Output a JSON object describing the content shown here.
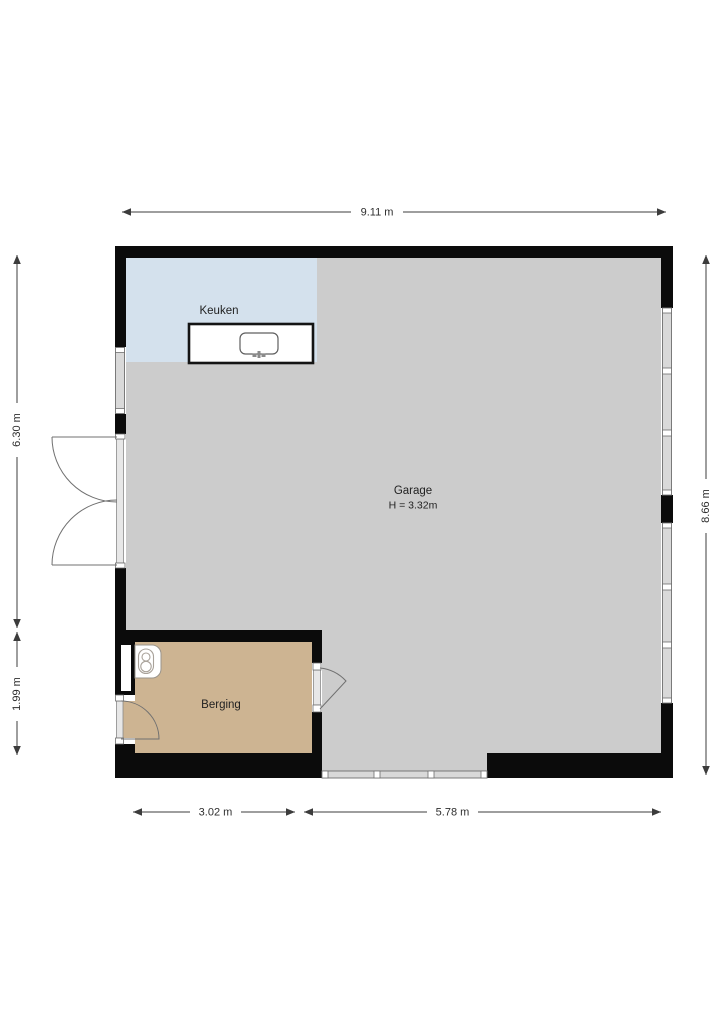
{
  "plan": {
    "title": "floor-plan",
    "rooms": {
      "keuken": {
        "label": "Keuken"
      },
      "garage": {
        "label": "Garage",
        "height": "H = 3.32m"
      },
      "berging": {
        "label": "Berging"
      }
    },
    "dimensions": {
      "top_width": "9.11 m",
      "left_upper": "6.30 m",
      "left_lower": "1.99 m",
      "right_height": "8.66 m",
      "bottom_left": "3.02 m",
      "bottom_right": "5.78 m"
    },
    "colors": {
      "wall": "#0b0b0b",
      "garage_floor": "#cccccc",
      "keuken_floor": "#d4e1ed",
      "berging_floor": "#cdb492",
      "window_glass": "#d9d9d9",
      "background": "#ffffff"
    },
    "fixtures": {
      "kitchen_counter": "counter-with-sink",
      "berging_boiler": "boiler"
    }
  }
}
